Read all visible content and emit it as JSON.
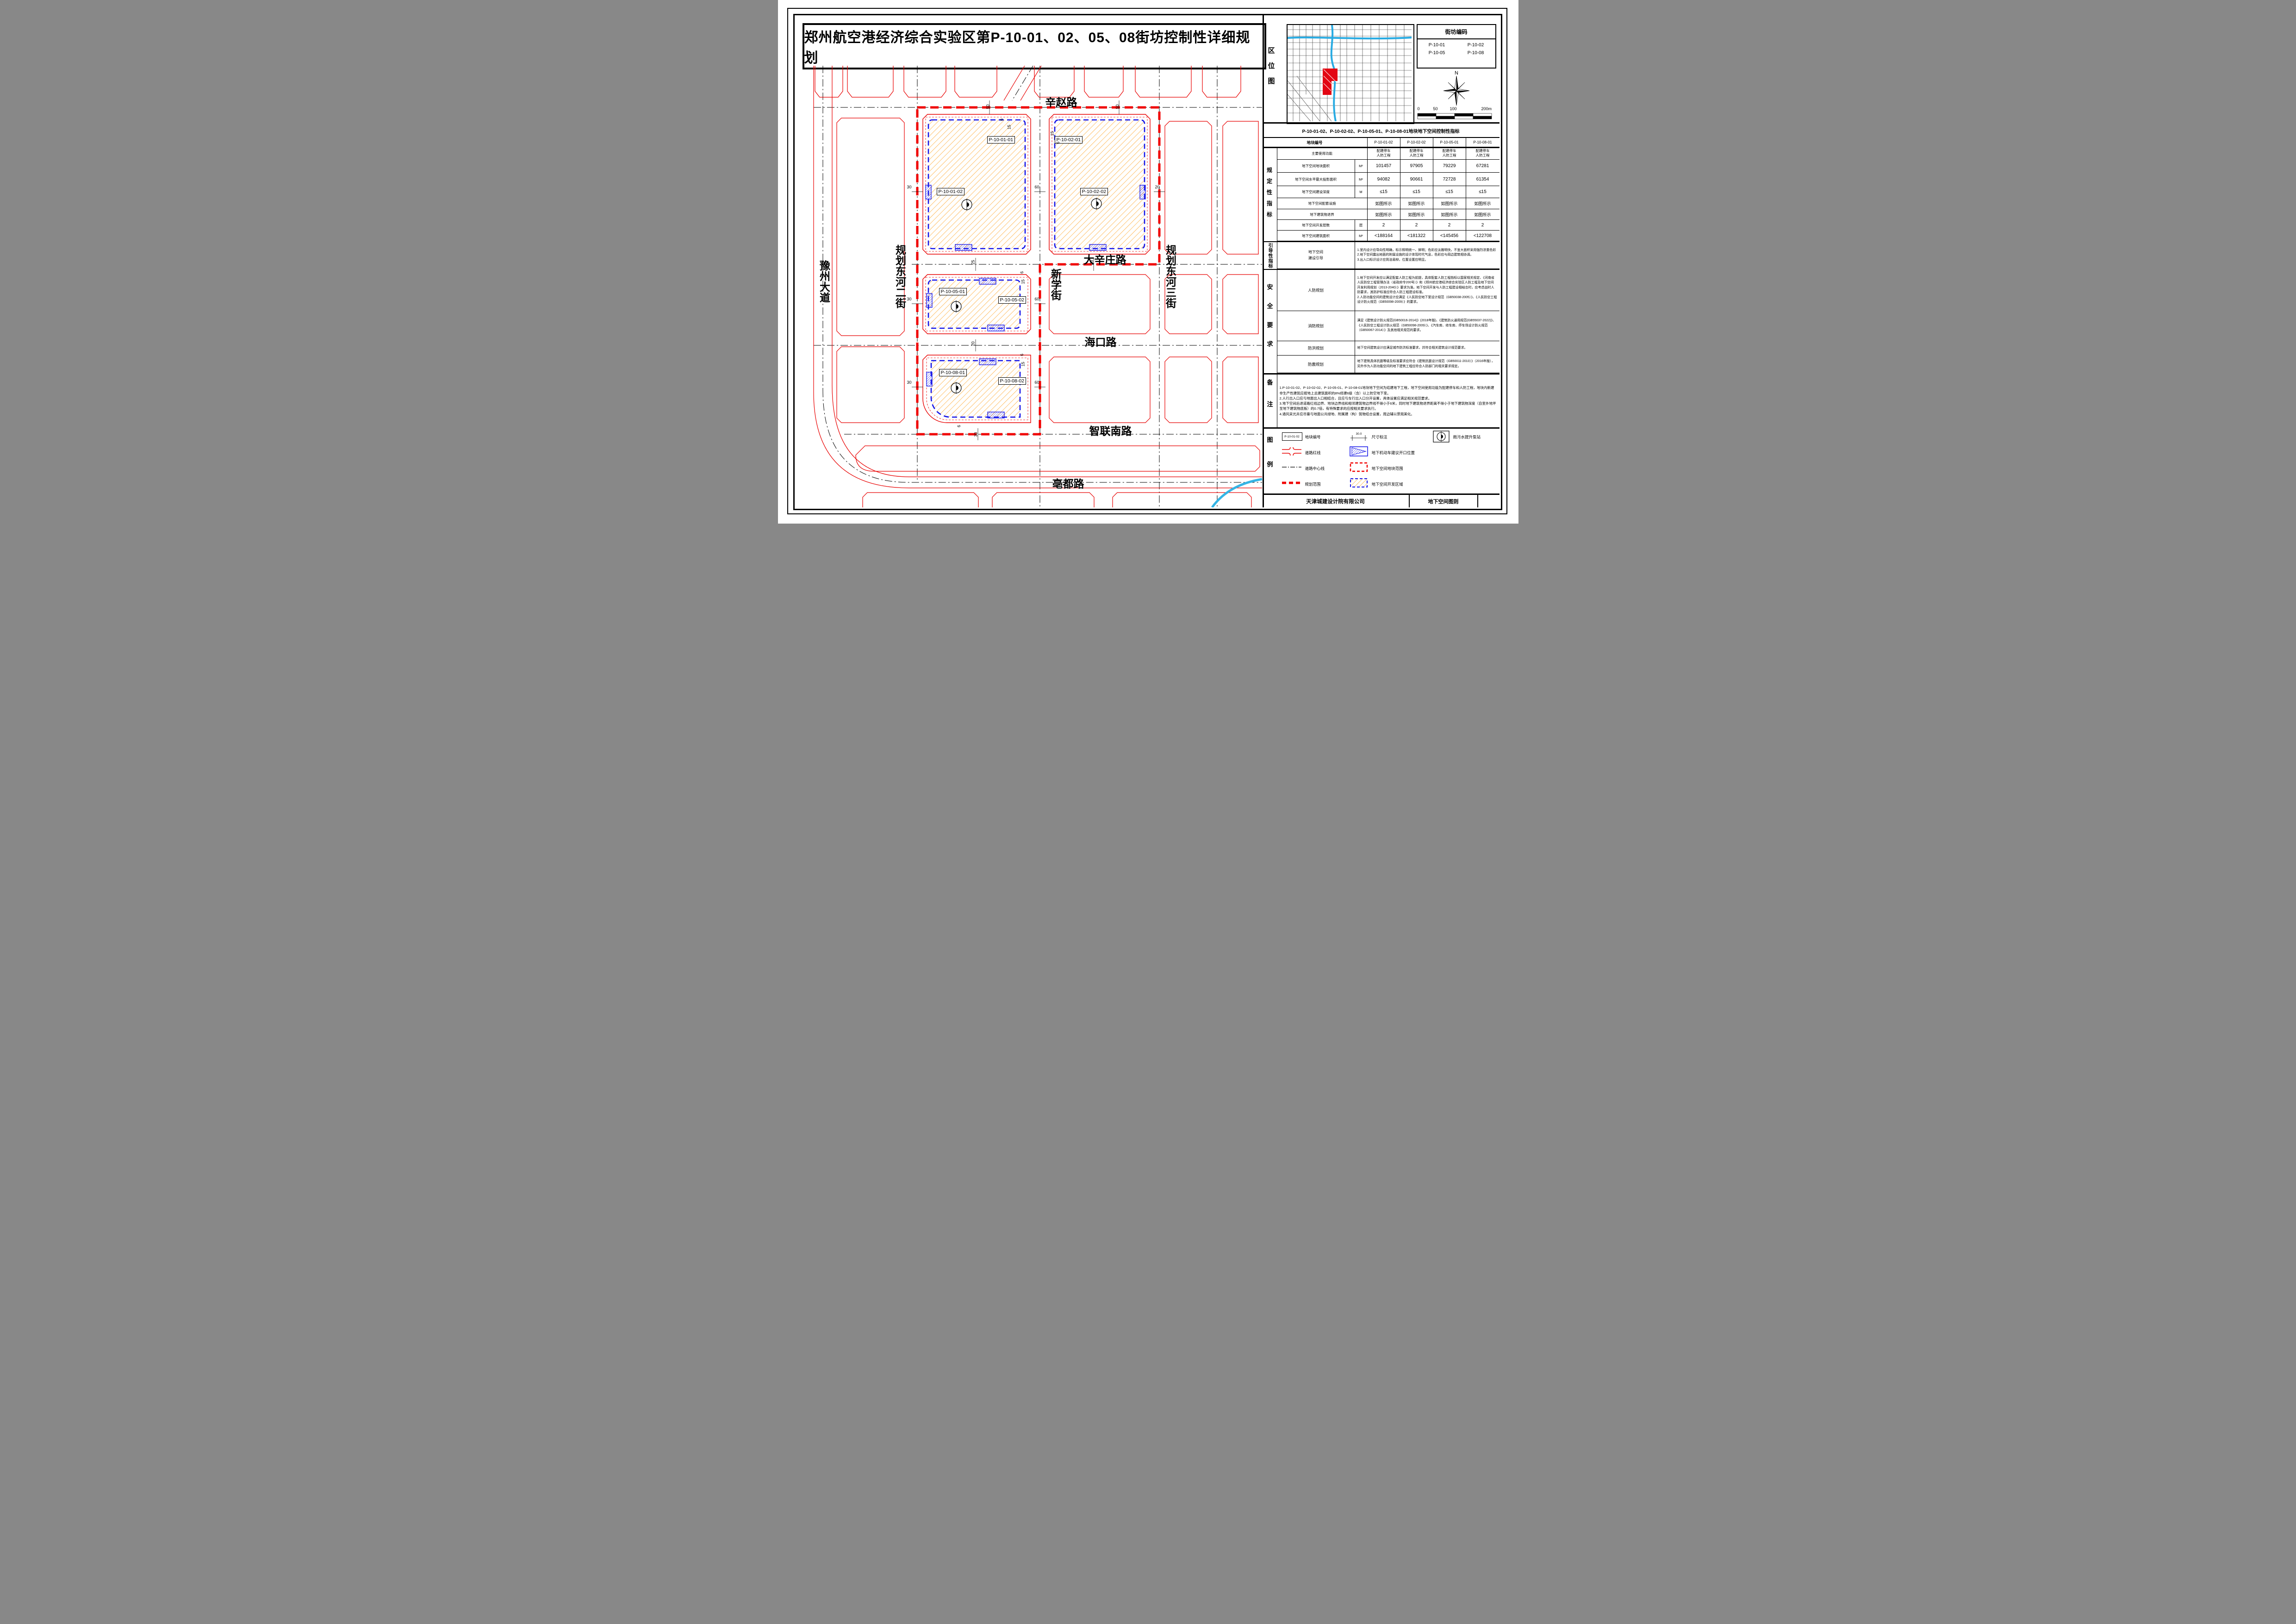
{
  "title": "郑州航空港经济综合实验区第P-10-01、02、05、08街坊控制性详细规划",
  "location_panel": {
    "label": "区位图",
    "block_code_title": "街坊编码",
    "block_codes": [
      "P-10-01",
      "P-10-02",
      "P-10-05",
      "P-10-08"
    ],
    "compass_label": "N",
    "scale_labels": [
      "0",
      "50",
      "100",
      "200m"
    ]
  },
  "indicator_table": {
    "title": "P-10-01-02、P-10-02-02、P-10-05-01、P-10-08-01地块地下空间控制性指标",
    "header_label": "地块编号",
    "columns": [
      "P-10-01-02",
      "P-10-02-02",
      "P-10-05-01",
      "P-10-08-01"
    ],
    "group_label": "规定性指标",
    "rows": [
      {
        "label": "主要使用功能",
        "unit": "",
        "values": [
          "配建停车\n人防工程",
          "配建停车\n人防工程",
          "配建停车\n人防工程",
          "配建停车\n人防工程"
        ]
      },
      {
        "label": "地下空间地块面积",
        "unit": "M²",
        "values": [
          "101457",
          "97905",
          "79229",
          "67281"
        ]
      },
      {
        "label": "地下空间水平最大投影面积",
        "unit": "M²",
        "values": [
          "94082",
          "90661",
          "72728",
          "61354"
        ]
      },
      {
        "label": "地下空间建设深度",
        "unit": "M",
        "values": [
          "≤15",
          "≤15",
          "≤15",
          "≤15"
        ]
      },
      {
        "label": "地下空间配套设施",
        "unit": "",
        "values": [
          "如图所示",
          "如图所示",
          "如图所示",
          "如图所示"
        ]
      },
      {
        "label": "地下建筑物退界",
        "unit": "",
        "values": [
          "如图所示",
          "如图所示",
          "如图所示",
          "如图所示"
        ]
      },
      {
        "label": "地下空间开发层数",
        "unit": "层",
        "values": [
          "2",
          "2",
          "2",
          "2"
        ]
      },
      {
        "label": "地下空间建筑面积",
        "unit": "M²",
        "values": [
          "<188164",
          "<181322",
          "<145456",
          "<122708"
        ]
      }
    ]
  },
  "guidance": {
    "group_label": "引导性指标",
    "row_label": "地下空间\n建设引导",
    "text": "1.室内设计应导向性明确，标示照明统一、鲜明；色彩应淡雅明快，不宜大面积采用强烈浓重色彩\n2.地下空间露出地面的附属设施的设计体现时代气息，色彩应与周边建筑相协调。\n3.出入口标识设计应简洁易辩，位置设置应明显。"
  },
  "safety": {
    "group_label": "安全要求",
    "rows": [
      {
        "label": "人防规划",
        "text": "1.地下空间开发应以满足配套人防工程为前提，具体配套人防工程指标以国家相关规定、《河南省人民防空工程管理办法（省政府令200号）》和《郑州航空港经济综合实验区人防工程及地下空间开发利用规划（2013-2040）》要求为准。地下空间开发与人防工程建设相结合时，应考虑战时人防要求，其防护标准应符合人防工程建设标准。\n2.人防功能空间的建筑设计应满足《人民防空地下室设计规范（GB50038-2005）》、《人民防空工程设计防火规范（GB50098-2009）》的要求。"
      },
      {
        "label": "消防规划",
        "text": "满足《建筑设计防火规范(GB50016-2014)》(2018年版)、《建筑防火通用规范(GB55037-2022)》、《人民防空工程设计防火规范（GB50098-2009）》、《汽车库、修车库、停车场设计防火规范（GB50067-2014）》及其他相关规范的要求。"
      },
      {
        "label": "防洪规划",
        "text": "地下空间建筑设计应满足城市防洪标准要求，并符合相关建筑设计规范要求。"
      },
      {
        "label": "防震规划",
        "text": "地下建筑具体抗震等级及标准要求应符合《建筑抗震设计规范（GB50011-2010）》（2016年版），另外作为人防功能空间的地下建筑工程应符合人防部门的相关要求规定。"
      }
    ]
  },
  "notes": {
    "group_label": "备注",
    "text": "1.P-10-01-02、P-10-02-02、P-10-05-01、P-10-08-01地块地下空间为结建地下工程，地下空间使用功能为配建停车和人防工程，地块内新建非生产性建筑应按地上总建筑面积的8%修建6级（含）以上防空地下室。\n2.人行出入口应与地面出入口相结合，且应与车行出入口分开设置，具体设置应满足相关规范要求。\n3.地下空间后退道路红线边界、地块边界线和相邻建筑物边界线不得小于6米，同时地下建筑物退界距离不得小于地下建筑物深度（自室外地坪至地下建筑物底板）的0.7倍，有特殊要求的应按相关要求执行。\n4.通风采光井应尽量与地面公共绿地、附属建（构）筑物结合设置，周边辅以景观美化。"
  },
  "legend": {
    "group_label": "图例",
    "sample_code": "P-10-01-02",
    "sample_dim": "30.0",
    "items": [
      {
        "name": "block-code",
        "label": "地块编号"
      },
      {
        "name": "road-red-line",
        "label": "道路红线"
      },
      {
        "name": "road-center-line",
        "label": "道路中心线"
      },
      {
        "name": "planning-scope",
        "label": "规划范围"
      },
      {
        "name": "dimension",
        "label": "尺寸标注"
      },
      {
        "name": "vehicle-opening",
        "label": "地下机动车建议开口位置"
      },
      {
        "name": "underground-block-extent",
        "label": "地下空间地块范围"
      },
      {
        "name": "underground-dev-area",
        "label": "地下空间开发区域"
      },
      {
        "name": "pump-station",
        "label": "雨污水提升泵站"
      }
    ]
  },
  "footer": {
    "company": "天津城建设计院有限公司",
    "sheet_name": "地下空间图则"
  },
  "map": {
    "roads": {
      "xinzhao": "辛赵路",
      "daxinzhuang": "大辛庄路",
      "haikou": "海口路",
      "zhiliannan": "智联南路",
      "bodu": "亳都路",
      "yuzhou": "豫州大道",
      "donghe2": "规划东河二街",
      "xinxue": "新学街",
      "donghe3": "规划东河三街"
    },
    "blocks": [
      "P-10-01-01",
      "P-10-01-02",
      "P-10-02-01",
      "P-10-02-02",
      "P-10-05-01",
      "P-10-05-02",
      "P-10-08-01",
      "P-10-08-02"
    ],
    "dims": [
      "50",
      "50",
      "30",
      "60",
      "20",
      "15",
      "6",
      "15",
      "6",
      "25",
      "25",
      "30",
      "60",
      "15",
      "6",
      "20",
      "30",
      "60",
      "15",
      "6",
      "30",
      "6"
    ],
    "colors": {
      "road_red": "#e80000",
      "planning_scope": "#f00000",
      "dev_blue": "#1515e8",
      "hatch_orange": "#ff9f1a",
      "river_blue": "#35b5e5"
    }
  }
}
